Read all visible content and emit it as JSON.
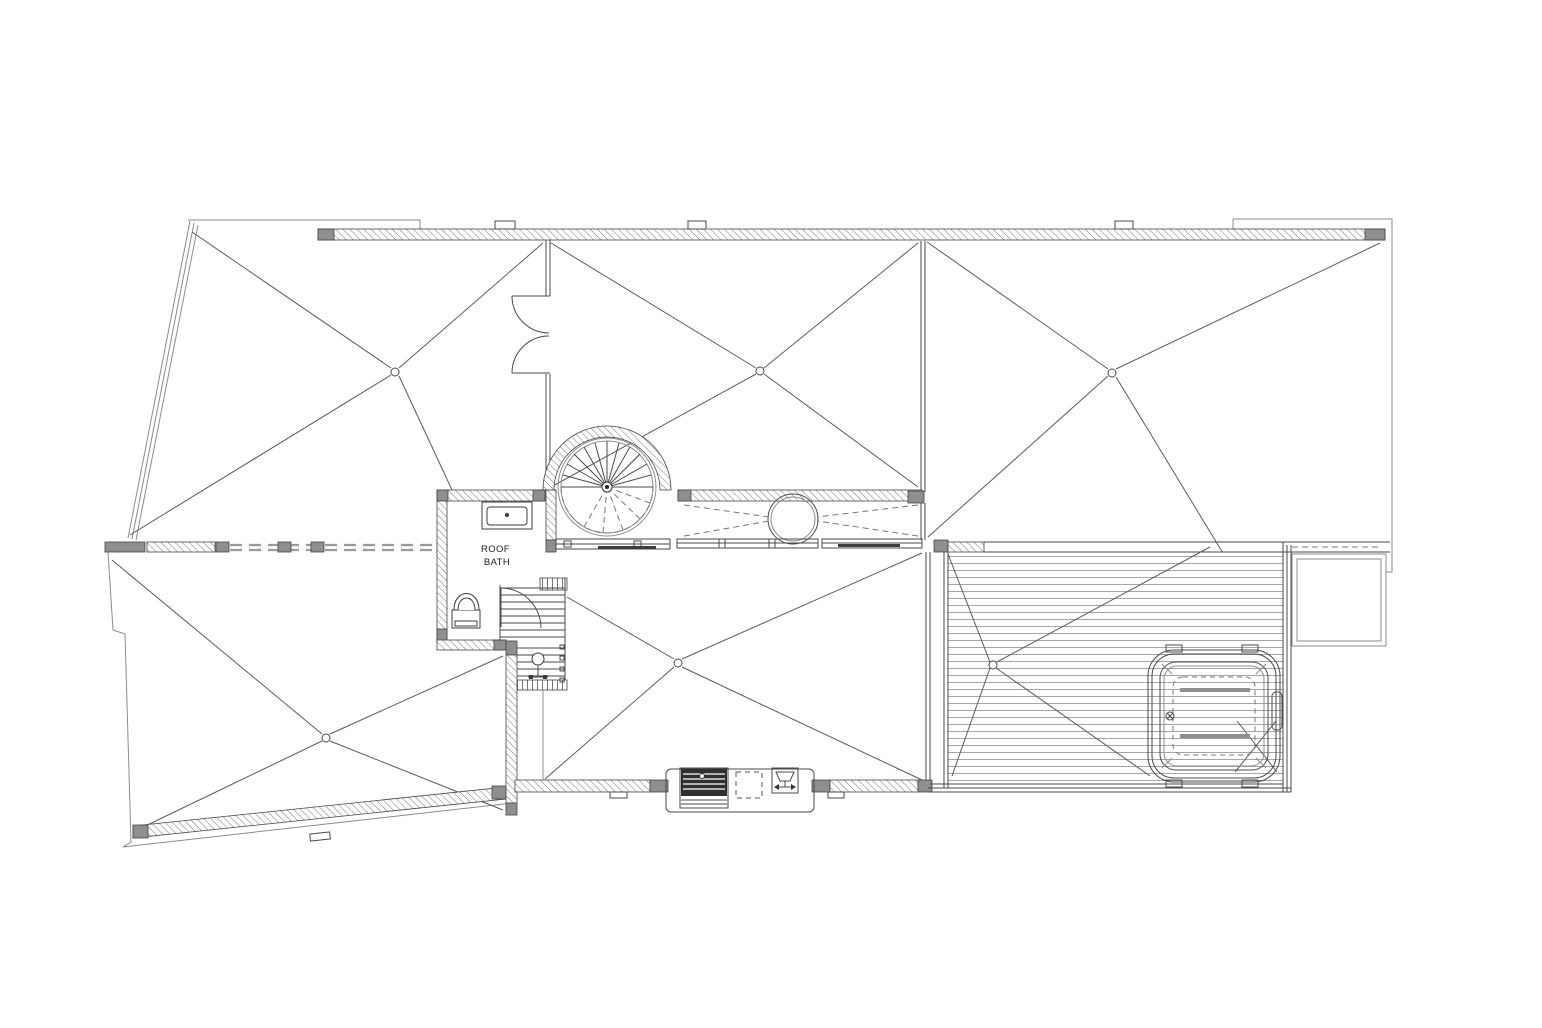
{
  "plan": {
    "type": "architectural-roof-plan",
    "room_label": {
      "line1": "ROOF",
      "line2": "BATH"
    },
    "colors": {
      "background": "#ffffff",
      "line": "#4a4a4a",
      "light_line": "#8c8c8c",
      "wall_block": "#8f8f8f",
      "grill_dark": "#2f2f2f"
    },
    "elements": [
      "parapet-wall",
      "roof-section-upper-left",
      "roof-section-upper-middle",
      "roof-section-upper-right",
      "roof-section-lower-left",
      "roof-section-lower-middle",
      "double-door",
      "spiral-staircase",
      "roof-bath-room",
      "sink",
      "toilet",
      "main-staircase",
      "stair-door",
      "skylight",
      "window-band",
      "dashed-wall",
      "deck",
      "hot-tub",
      "outdoor-kitchen",
      "grill",
      "outdoor-sink",
      "lower-roof-step"
    ]
  }
}
